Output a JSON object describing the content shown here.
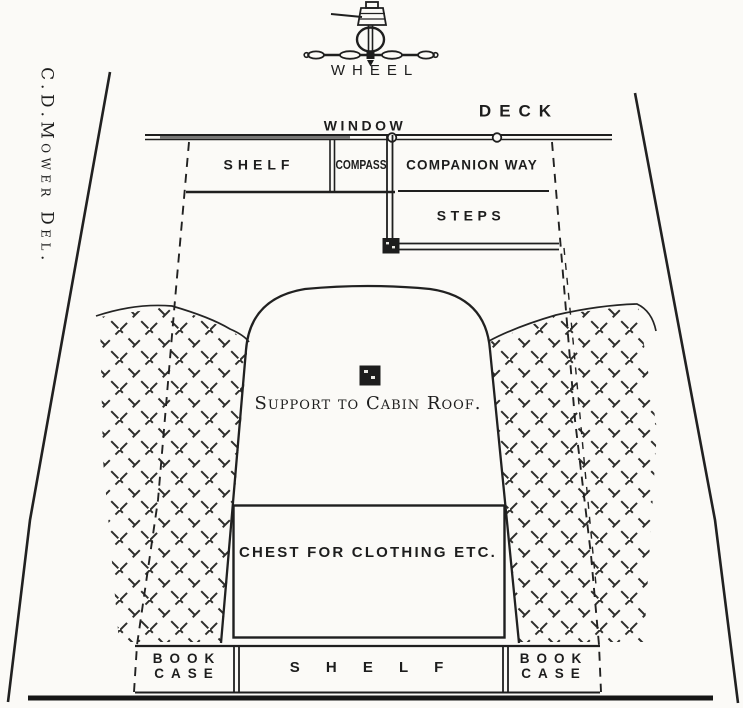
{
  "figure": {
    "type": "boat-cockpit-and-cabin-plan",
    "paper_color": "#fbfaf7",
    "ink_color": "#1d1d1d",
    "credit": "C.D.Mower Del.",
    "labels": {
      "wheel": "WHEEL",
      "deck": "DECK",
      "window": "WINDOW",
      "shelf_top": "SHELF",
      "compass": "COMPASS",
      "companion_way": "COMPANION WAY",
      "steps": "STEPS",
      "support": "Support to Cabin Roof.",
      "chest": "CHEST FOR CLOTHING ETC.",
      "shelf_bottom": "S H E L F",
      "bookcase_left": [
        "BOOK",
        "CASE"
      ],
      "bookcase_right": [
        "BOOK",
        "CASE"
      ]
    }
  }
}
